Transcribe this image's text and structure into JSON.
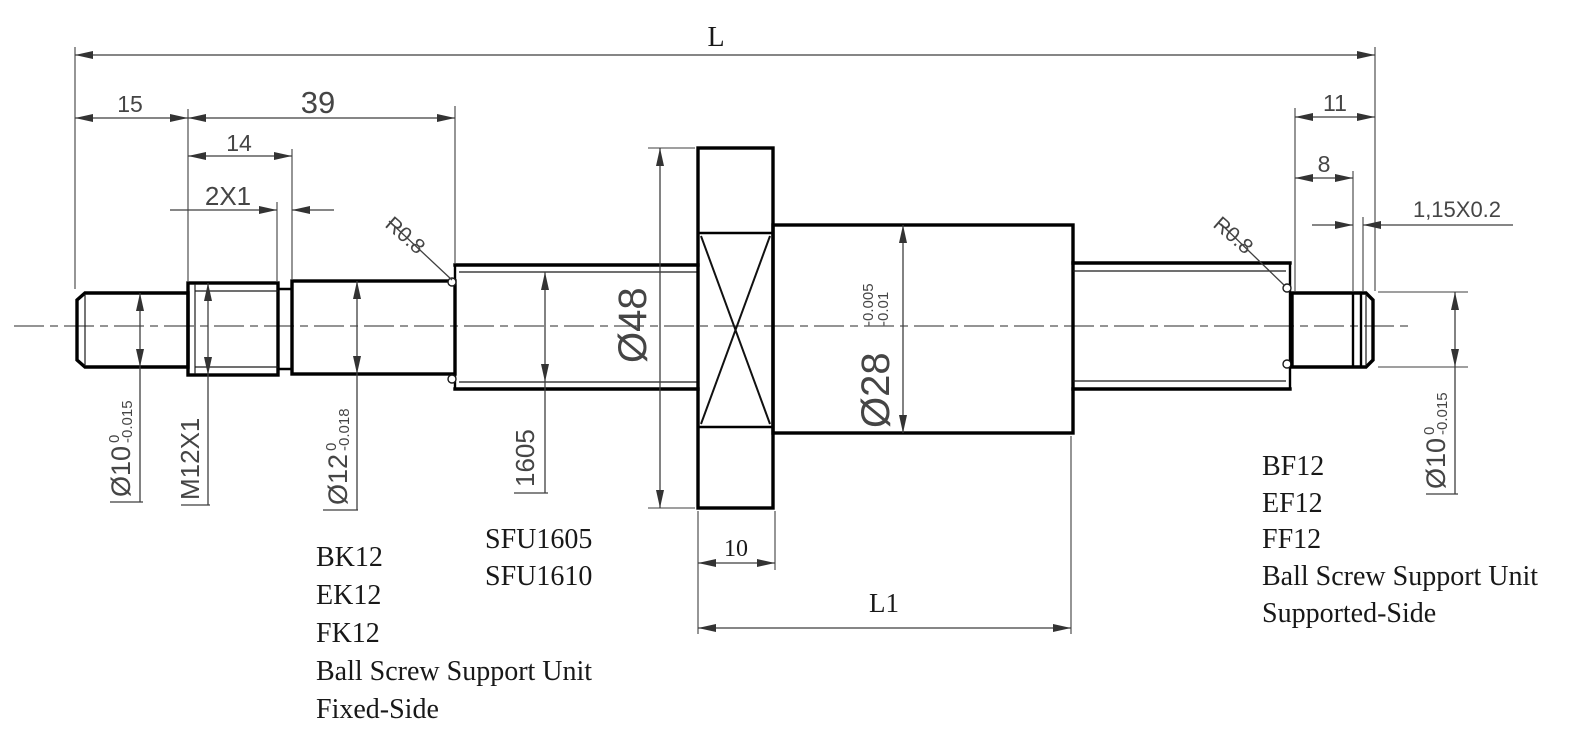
{
  "drawing": {
    "description": "Ball screw SFU1605 dimensional drawing",
    "dims": {
      "len_total": "L",
      "len_15": "15",
      "len_39": "39",
      "len_14": "14",
      "groove_2x1": "2X1",
      "fillet_left": "R0.8",
      "fillet_right": "R0.8",
      "len_11": "11",
      "len_8": "8",
      "groove_115": "1,15X0.2",
      "flange_width": "10",
      "nut_length": "L1"
    },
    "diameters": {
      "left_end": {
        "value": "Ø10",
        "tol_upper": "0",
        "tol_lower": "-0.015"
      },
      "thread": {
        "value": "M12X1"
      },
      "journal": {
        "value": "Ø12",
        "tol_upper": "0",
        "tol_lower": "-0.018"
      },
      "screw": {
        "value": "1605"
      },
      "flange": {
        "value": "Ø48"
      },
      "nut": {
        "value": "Ø28",
        "tol_upper": "-0.005",
        "tol_lower": "-0.01"
      },
      "right_end": {
        "value": "Ø10",
        "tol_upper": "0",
        "tol_lower": "-0.015"
      }
    },
    "notes": {
      "screw_models": {
        "lines": [
          "SFU1605",
          "SFU1610"
        ]
      },
      "fixed_side": {
        "lines": [
          "BK12",
          "EK12",
          "FK12",
          "Ball Screw Support Unit",
          "Fixed-Side"
        ]
      },
      "supported_side": {
        "lines": [
          "BF12",
          "EF12",
          "FF12",
          "Ball Screw Support Unit",
          "Supported-Side"
        ]
      }
    },
    "colors": {
      "line": "#000000",
      "dim_text": "#454545",
      "note_text": "#181818",
      "background": "#ffffff"
    }
  }
}
